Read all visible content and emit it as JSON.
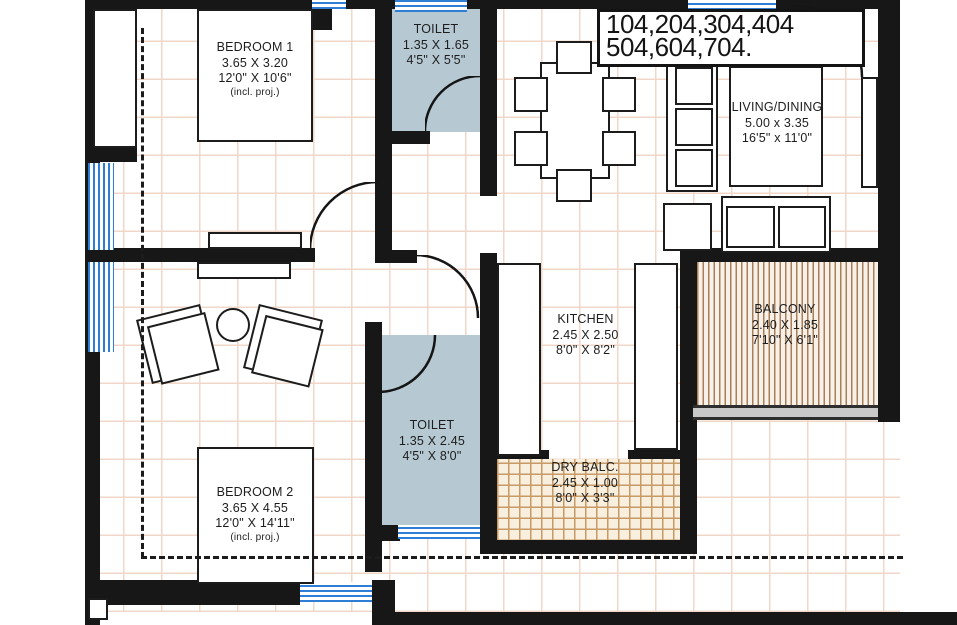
{
  "title": {
    "line1": "104,204,304,404",
    "line2": "504,604,704."
  },
  "rooms": {
    "bedroom1": {
      "name": "BEDROOM 1",
      "dim_m": "3.65 X 3.20",
      "dim_ft": "12'0\" X 10'6\"",
      "note": "(incl. proj.)"
    },
    "bedroom2": {
      "name": "BEDROOM 2",
      "dim_m": "3.65 X 4.55",
      "dim_ft": "12'0\" X 14'11\"",
      "note": "(incl. proj.)"
    },
    "toilet1": {
      "name": "TOILET",
      "dim_m": "1.35 X 1.65",
      "dim_ft": "4'5\" X 5'5\""
    },
    "toilet2": {
      "name": "TOILET",
      "dim_m": "1.35 X 2.45",
      "dim_ft": "4'5\" X 8'0\""
    },
    "living": {
      "name": "LIVING/DINING",
      "dim_m": "5.00 x 3.35",
      "dim_ft": "16'5\" x 11'0\""
    },
    "kitchen": {
      "name": "KITCHEN",
      "dim_m": "2.45 X 2.50",
      "dim_ft": "8'0\" X 8'2\""
    },
    "balcony": {
      "name": "BALCONY",
      "dim_m": "2.40 X 1.85",
      "dim_ft": "7'10\" X 6'1\""
    },
    "dry_balcony": {
      "name": "DRY BALC.",
      "dim_m": "2.45 X 1.00",
      "dim_ft": "8'0\" X 3'3\""
    }
  },
  "colors": {
    "wall": "#171717",
    "toilet_fill": "#b6c9d3",
    "window_blue": "#2e7ed5",
    "balcony_stripe": "#aa7f58",
    "dry_balc_tile": "#c79a66",
    "floor_grid": "#f1d7c7",
    "railing_gray": "#c9c9c9"
  }
}
